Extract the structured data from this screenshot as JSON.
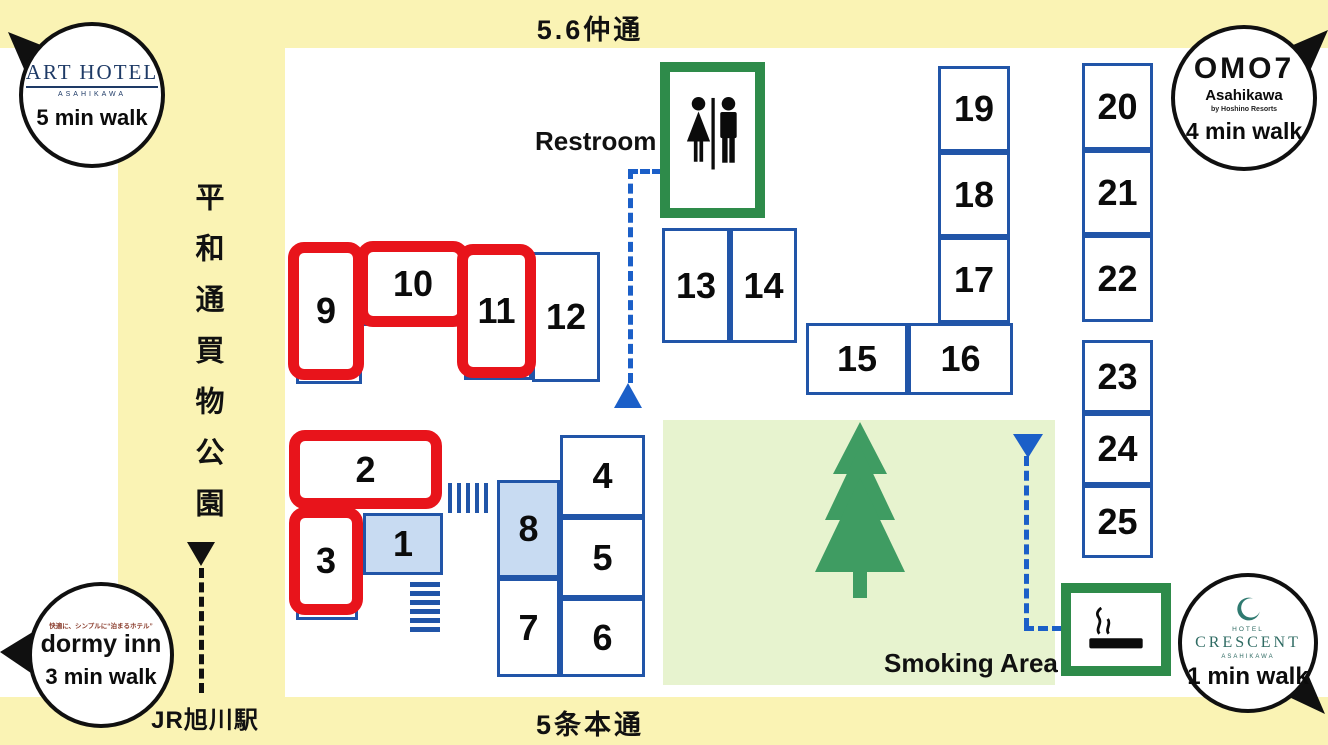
{
  "streets": {
    "top": "5.6仲通",
    "bottom": "5条本通",
    "left": "平和通買物公園",
    "station": "JR旭川駅"
  },
  "facilities": {
    "restroom_label": "Restroom",
    "smoking_label": "Smoking Area"
  },
  "hotels": {
    "art_hotel": {
      "name": "ART HOTEL",
      "subname": "ASAHIKAWA",
      "walk": "5 min walk"
    },
    "omo7": {
      "name": "OMO7",
      "subname": "Asahikawa",
      "byline": "by Hoshino Resorts",
      "walk": "4 min walk"
    },
    "dormy_inn": {
      "tagline": "快適に、シンプルに“泊まるホテル”",
      "name": "dormy inn",
      "walk": "3 min walk"
    },
    "crescent": {
      "pre": "HOTEL",
      "name": "CRESCENT",
      "subname": "ASAHIKAWA",
      "walk": "1 min walk"
    }
  },
  "booths": [
    {
      "label": "1",
      "highlighted": false
    },
    {
      "label": "2",
      "highlighted": true
    },
    {
      "label": "3",
      "highlighted": true
    },
    {
      "label": "4",
      "highlighted": false
    },
    {
      "label": "5",
      "highlighted": false
    },
    {
      "label": "6",
      "highlighted": false
    },
    {
      "label": "7",
      "highlighted": false
    },
    {
      "label": "8",
      "highlighted": false
    },
    {
      "label": "9",
      "highlighted": true
    },
    {
      "label": "10",
      "highlighted": true
    },
    {
      "label": "11",
      "highlighted": true
    },
    {
      "label": "12",
      "highlighted": false
    },
    {
      "label": "13",
      "highlighted": false
    },
    {
      "label": "14",
      "highlighted": false
    },
    {
      "label": "15",
      "highlighted": false
    },
    {
      "label": "16",
      "highlighted": false
    },
    {
      "label": "17",
      "highlighted": false
    },
    {
      "label": "18",
      "highlighted": false
    },
    {
      "label": "19",
      "highlighted": false
    },
    {
      "label": "20",
      "highlighted": false
    },
    {
      "label": "21",
      "highlighted": false
    },
    {
      "label": "22",
      "highlighted": false
    },
    {
      "label": "23",
      "highlighted": false
    },
    {
      "label": "24",
      "highlighted": false
    },
    {
      "label": "25",
      "highlighted": false
    }
  ],
  "colors": {
    "street_yellow": "#FAF3B4",
    "booth_border_blue": "#2155A8",
    "booth_fill_blue": "#C8DBF2",
    "highlight_red": "#E8141B",
    "facility_green": "#2E8B4A",
    "park_green_bg": "#E7F3CF",
    "path_blue": "#1B5FC8"
  }
}
